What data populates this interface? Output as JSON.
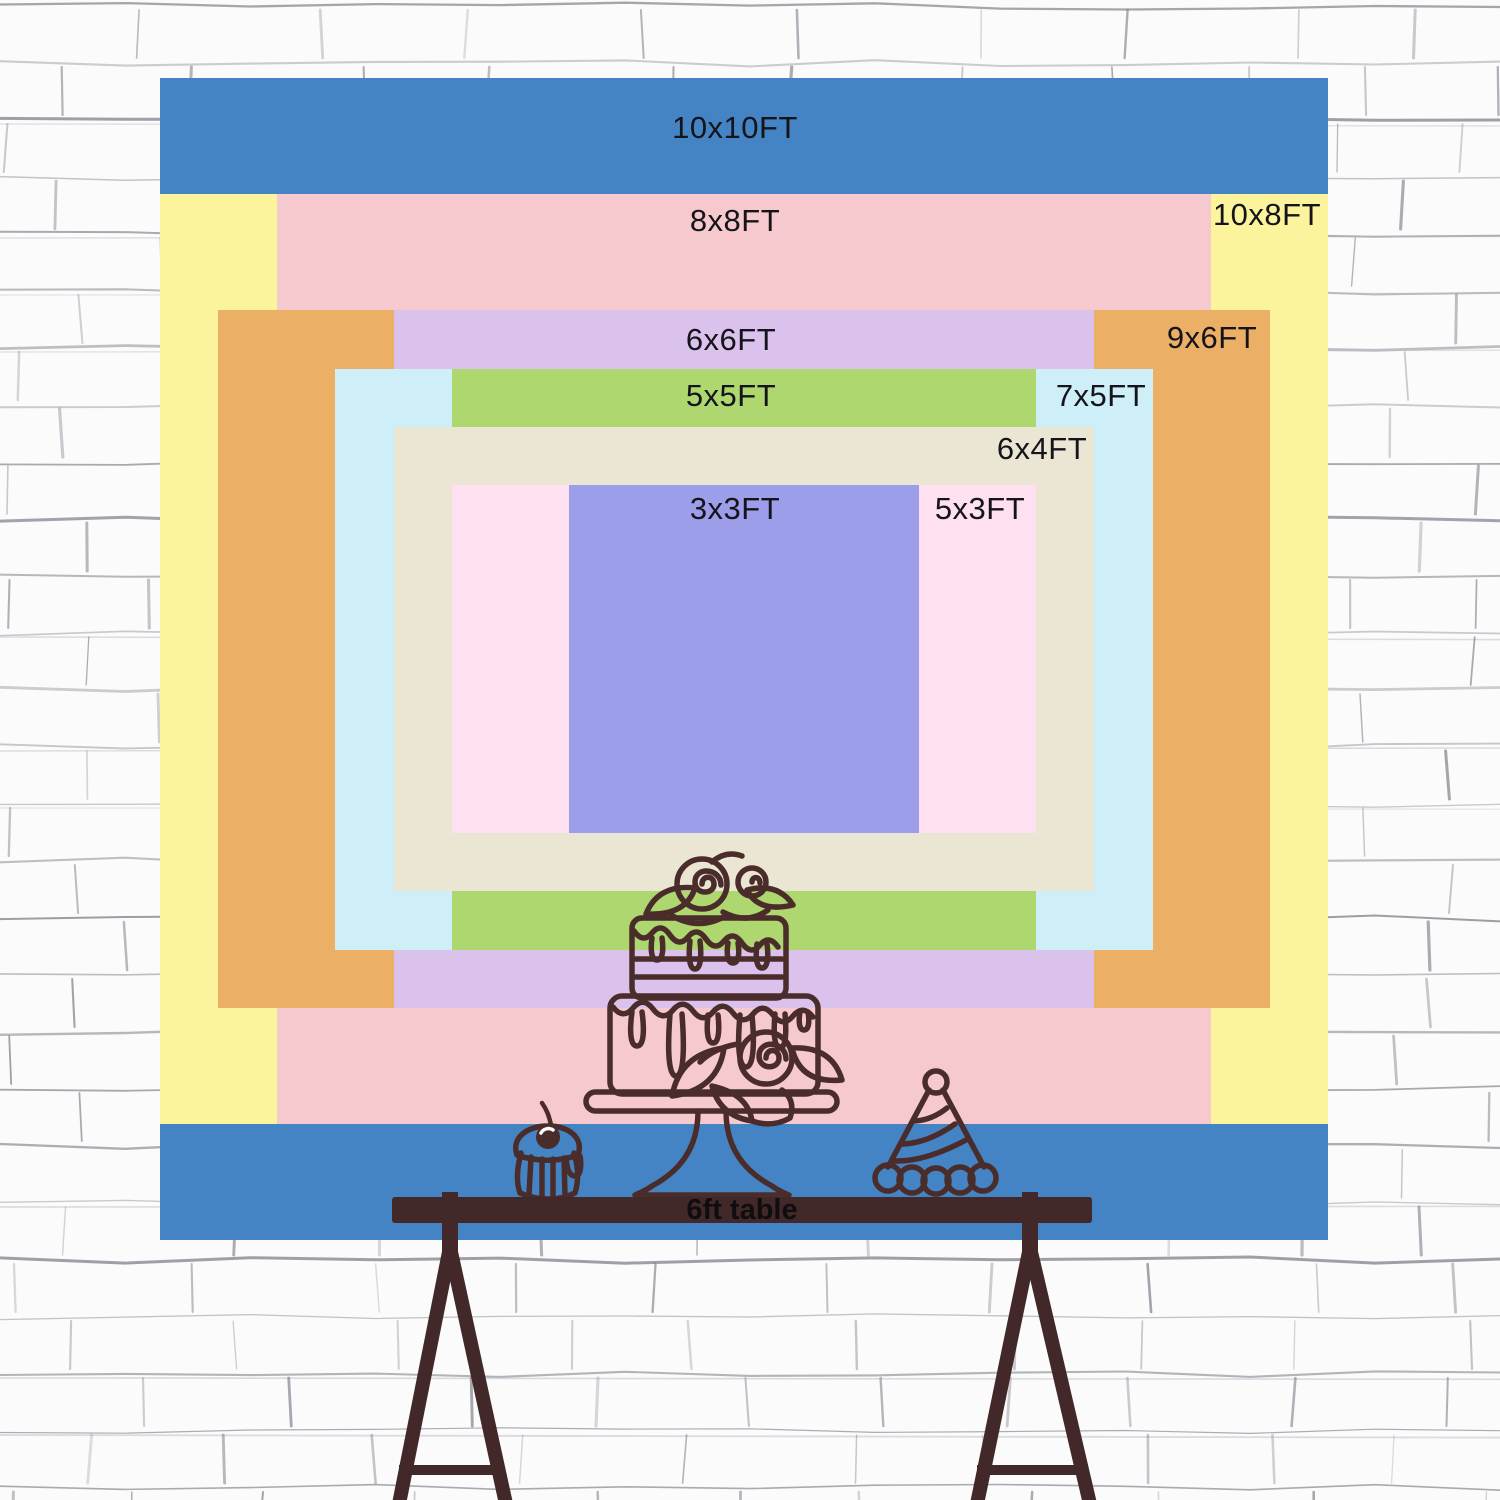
{
  "scene": {
    "background_name": "white-brick-wall",
    "wall_bg": "#fbfbfc",
    "wall_line_color": "#73737f",
    "wall_line_color_light": "#bcbcc6"
  },
  "chart": {
    "unit": "FT",
    "px_per_ft": {
      "x": 116.8,
      "y": 116.2
    },
    "center": {
      "x": 584,
      "y": 581
    },
    "label_color": "#14141a",
    "sizes": [
      {
        "id": "10x10",
        "label": "10x10FT",
        "w_ft": 10,
        "h_ft": 10,
        "color": "#4484C4",
        "label_x": 575,
        "label_y": 50
      },
      {
        "id": "10x8",
        "label": "10x8FT",
        "w_ft": 10,
        "h_ft": 8,
        "color": "#FBF49D",
        "label_x": 1107,
        "label_y": 137
      },
      {
        "id": "8x8",
        "label": "8x8FT",
        "w_ft": 8,
        "h_ft": 8,
        "color": "#F5C9CD",
        "label_x": 575,
        "label_y": 143
      },
      {
        "id": "9x6",
        "label": "9x6FT",
        "w_ft": 9,
        "h_ft": 6,
        "color": "#ECAF66",
        "label_x": 1052,
        "label_y": 260
      },
      {
        "id": "6x6",
        "label": "6x6FT",
        "w_ft": 6,
        "h_ft": 6,
        "color": "#DAC2EC",
        "label_x": 571,
        "label_y": 262
      },
      {
        "id": "7x5",
        "label": "7x5FT",
        "w_ft": 7,
        "h_ft": 5,
        "color": "#CEEEF8",
        "label_x": 941,
        "label_y": 318
      },
      {
        "id": "5x5",
        "label": "5x5FT",
        "w_ft": 5,
        "h_ft": 5,
        "color": "#AFD76F",
        "label_x": 571,
        "label_y": 318
      },
      {
        "id": "6x4",
        "label": "6x4FT",
        "w_ft": 6,
        "h_ft": 4,
        "color": "#EBE6D4",
        "label_x": 882,
        "label_y": 371
      },
      {
        "id": "5x3",
        "label": "5x3FT",
        "w_ft": 5,
        "h_ft": 3,
        "color": "#FEE0F0",
        "label_x": 820,
        "label_y": 431
      },
      {
        "id": "3x3",
        "label": "3x3FT",
        "w_ft": 3,
        "h_ft": 3,
        "color": "#9C9EE9",
        "label_x": 575,
        "label_y": 431
      }
    ]
  },
  "table": {
    "label": "6ft table",
    "bar_color": "#432829",
    "text_color": "#0e0e10"
  },
  "illustration": {
    "line_color": "#4A2C2B",
    "highlight_color": "#fdfdfd",
    "items": [
      "tiered-cake",
      "cupcake-with-cherry",
      "party-hat"
    ]
  }
}
